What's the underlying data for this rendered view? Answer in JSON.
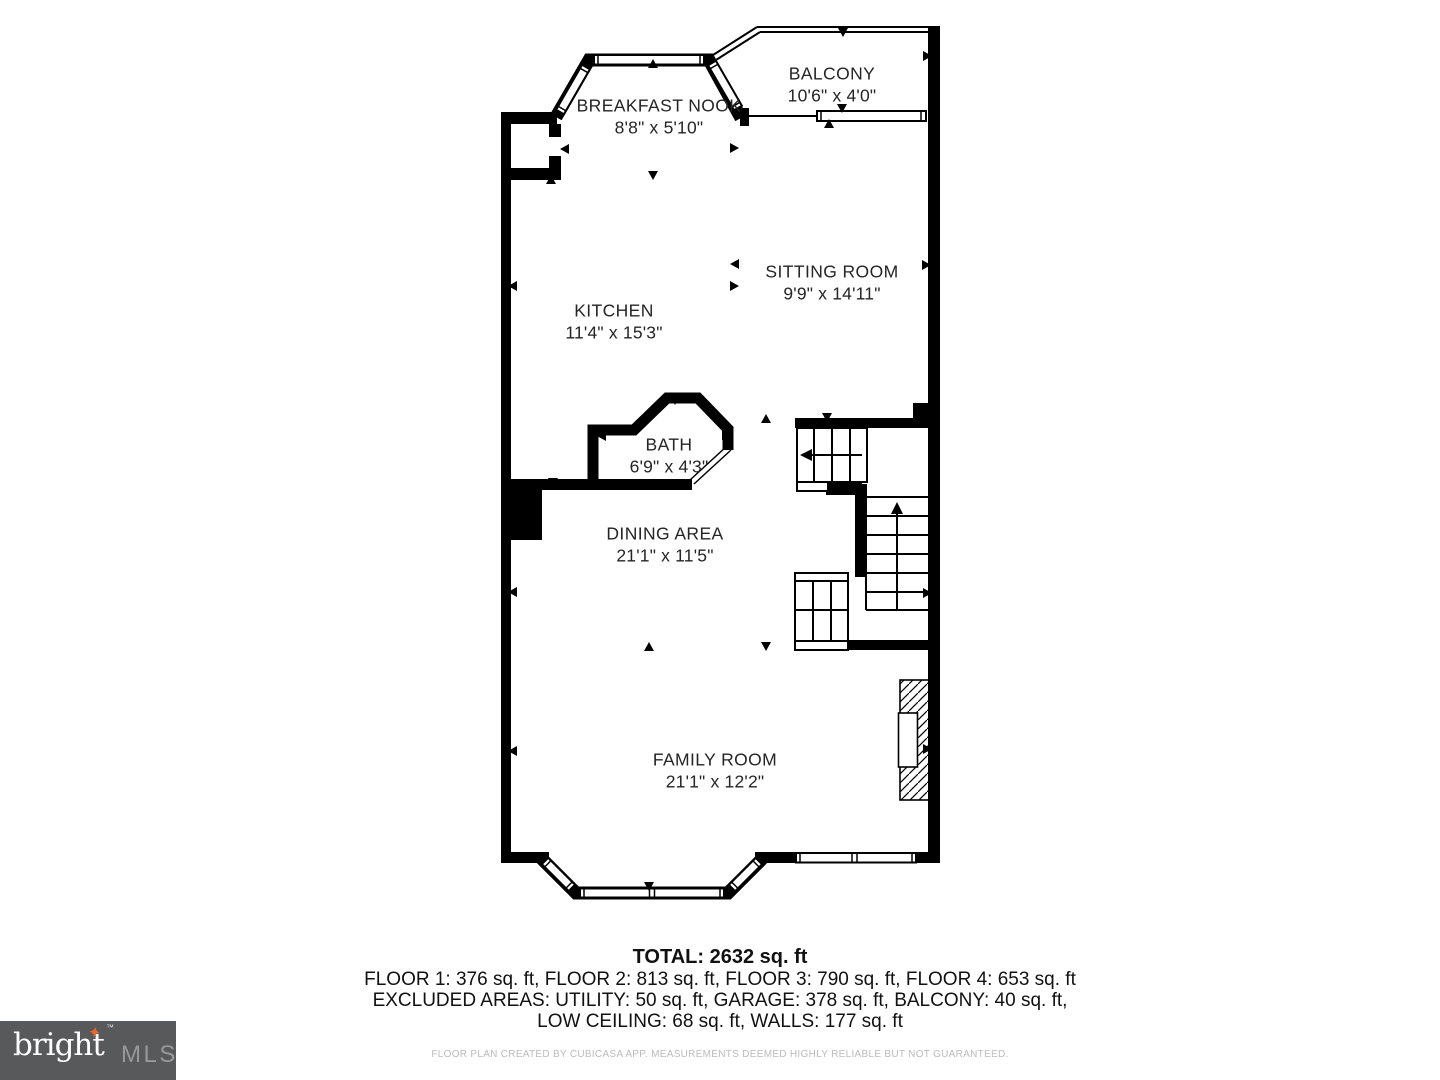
{
  "floor_plan": {
    "rooms": [
      {
        "name": "BREAKFAST NOOK",
        "dims": "8'8\" x 5'10\""
      },
      {
        "name": "BALCONY",
        "dims": "10'6\" x 4'0\""
      },
      {
        "name": "SITTING ROOM",
        "dims": "9'9\" x 14'11\""
      },
      {
        "name": "KITCHEN",
        "dims": "11'4\" x 15'3\""
      },
      {
        "name": "BATH",
        "dims": "6'9\" x 4'3\""
      },
      {
        "name": "DINING AREA",
        "dims": "21'1\" x 11'5\""
      },
      {
        "name": "FAMILY ROOM",
        "dims": "21'1\" x 12'2\""
      }
    ],
    "summary": {
      "total": "TOTAL: 2632 sq. ft",
      "floors": "FLOOR 1: 376 sq. ft, FLOOR 2: 813 sq. ft, FLOOR 3: 790 sq. ft, FLOOR 4: 653 sq. ft",
      "excluded_line1": "EXCLUDED AREAS: UTILITY: 50 sq. ft, GARAGE: 378 sq. ft, BALCONY: 40 sq. ft,",
      "excluded_line2": "LOW CEILING: 68 sq. ft, WALLS: 177 sq. ft",
      "disclaimer": "FLOOR PLAN CREATED BY CUBICASA APP. MEASUREMENTS DEEMED HIGHLY RELIABLE BUT NOT GUARANTEED."
    },
    "branding": {
      "logo_text": "bright",
      "logo_tm": "™",
      "logo_star": "✦",
      "logo_suffix": "MLS"
    },
    "colors": {
      "walls": "#000000",
      "label_text": "#252525",
      "logo_background": "#58595B",
      "logo_text_color": "#FFFFFF",
      "logo_star_color": "#E8672F",
      "logo_suffix_color": "#97989A",
      "disclaimer_text": "#BBBBBB"
    }
  }
}
